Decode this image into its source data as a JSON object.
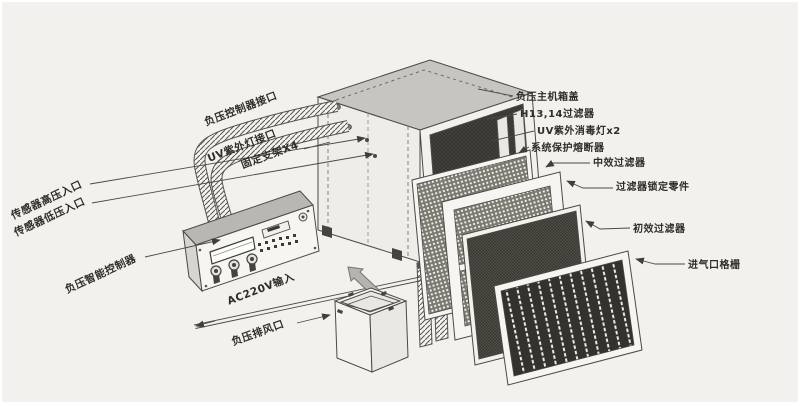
{
  "diagram_type": "exploded-parts-diagram",
  "labels": {
    "case_cover": "负压主机箱盖",
    "hepa_filter": "H13,14过滤器",
    "uv_lamp": "UV紫外消毒灯x2",
    "fuse": "系统保护熔断器",
    "mid_filter": "中效过滤器",
    "lock_parts": "过滤器锁定零件",
    "pre_filter": "初效过滤器",
    "inlet_grille": "进气口格栅",
    "ctrl_port": "负压控制器接口",
    "uv_port": "UV紫外灯接口",
    "bracket": "固定支架X4",
    "sensor_high": "传感器高压入口",
    "sensor_low": "传感器低压入口",
    "smart_ctrl": "负压智能控制器",
    "ac_input": "AC220V输入",
    "exhaust": "负压排风口"
  },
  "colors": {
    "bg": "#f2f1ed",
    "ink": "#2e2d29",
    "line": "#4b4a45",
    "lid": "#c6c5c1",
    "paper": "#f6f5f2",
    "dark_panel": "#34332e",
    "arrow_gray": "#b5b4b0"
  }
}
